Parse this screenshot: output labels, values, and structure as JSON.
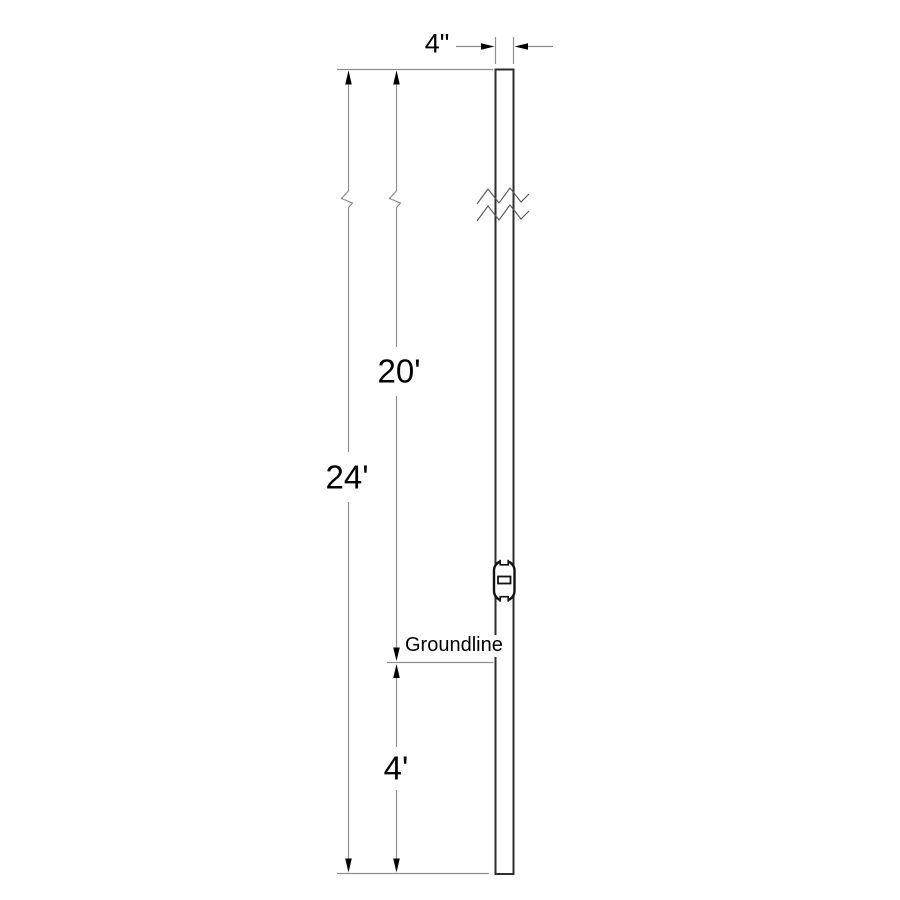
{
  "diagram": {
    "kind": "pole-elevation-drawing",
    "labels": {
      "pole_width": "4\"",
      "above_ground_height": "20'",
      "overall_height": "24'",
      "setting_depth": "4'",
      "groundline": "Groundline"
    },
    "colors": {
      "background": "#ffffff",
      "pole_outline": "#2e2e2e",
      "dimension_line": "#8f8f8f",
      "arrowhead": "#000000",
      "text": "#000000"
    }
  }
}
